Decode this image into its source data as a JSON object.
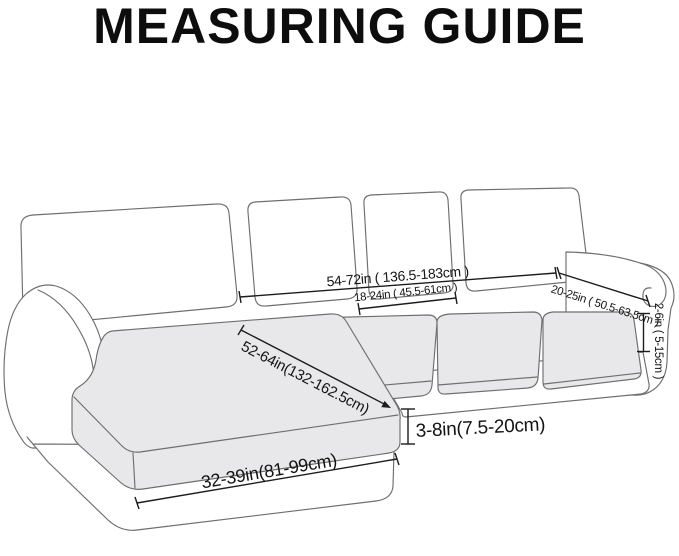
{
  "title": "MEASURING GUIDE",
  "diagram": {
    "subject": "sectional-sofa-with-chaise",
    "measurements": {
      "total_width": "54-72in ( 136.5-183cm )",
      "single_cushion_width": "18-24in ( 45.5-61cm )",
      "arm_top_length": "20-25in ( 50.5-63.5cm )",
      "arm_front_height": "2-6in ( 5-15cm )",
      "chaise_length": "52-64in(132-162.5cm)",
      "cushion_height": "3-8in(7.5-20cm)",
      "chaise_width": "32-39in(81-99cm)"
    },
    "colors": {
      "background": "#ffffff",
      "sofa_outline": "#6e6e6e",
      "seat_cushion_fill": "#e8e8ea",
      "measure_line": "#1c1c1c",
      "text": "#141414"
    }
  }
}
